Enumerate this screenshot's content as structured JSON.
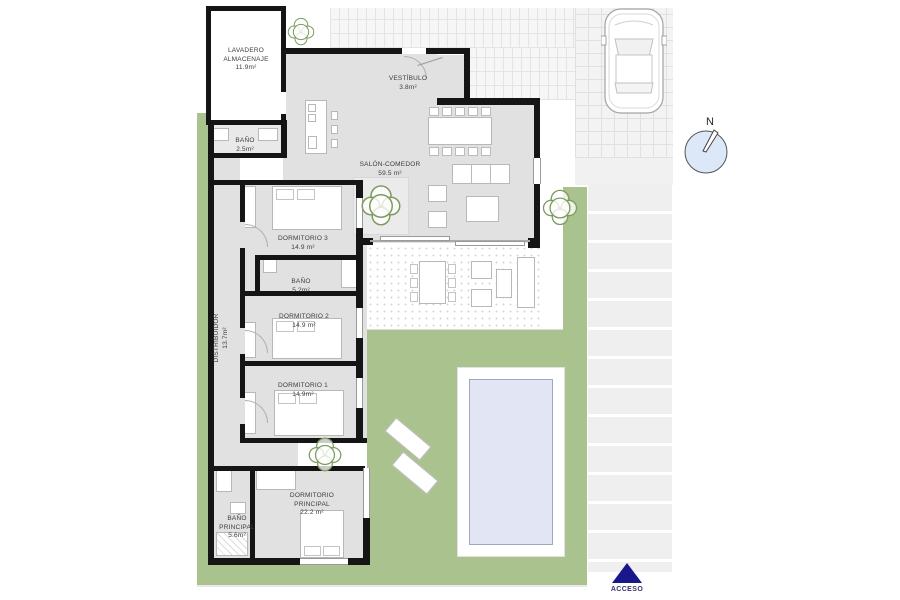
{
  "plan": {
    "rooms": [
      {
        "id": "lavadero",
        "name": "LAVADERO\nALMACENAJE",
        "area": "11.9m²"
      },
      {
        "id": "bano-1",
        "name": "BAÑO",
        "area": "2.5m²"
      },
      {
        "id": "vestibulo",
        "name": "VESTÍBULO",
        "area": "3.8m²"
      },
      {
        "id": "salon-comedor",
        "name": "SALÓN-COMEDOR",
        "area": "59.5 m²"
      },
      {
        "id": "dormitorio-3",
        "name": "DORMITORIO 3",
        "area": "14.9 m²"
      },
      {
        "id": "bano-2",
        "name": "BAÑO",
        "area": "5.2m²"
      },
      {
        "id": "dormitorio-2",
        "name": "DORMITORIO 2",
        "area": "14.9 m²"
      },
      {
        "id": "distribuidor",
        "name": "DISTRIBUIDOR",
        "area": "13.7m²"
      },
      {
        "id": "dormitorio-1",
        "name": "DORMITORIO 1",
        "area": "14.9m²"
      },
      {
        "id": "dormitorio-principal",
        "name": "DORMITORIO\nPRINCIPAL",
        "area": "22.2 m²"
      },
      {
        "id": "bano-principal",
        "name": "BAÑO\nPRINCIPAL",
        "area": "5.6m²"
      }
    ],
    "compass": {
      "label": "N"
    },
    "access": {
      "label": "ACCESO"
    },
    "colors": {
      "garden": "#a9c28e",
      "pool": "#e2e6f4",
      "wall": "#151515",
      "room": "#e1e1e1",
      "accent": "#18188c",
      "compass_fill": "#dce7f8"
    }
  }
}
